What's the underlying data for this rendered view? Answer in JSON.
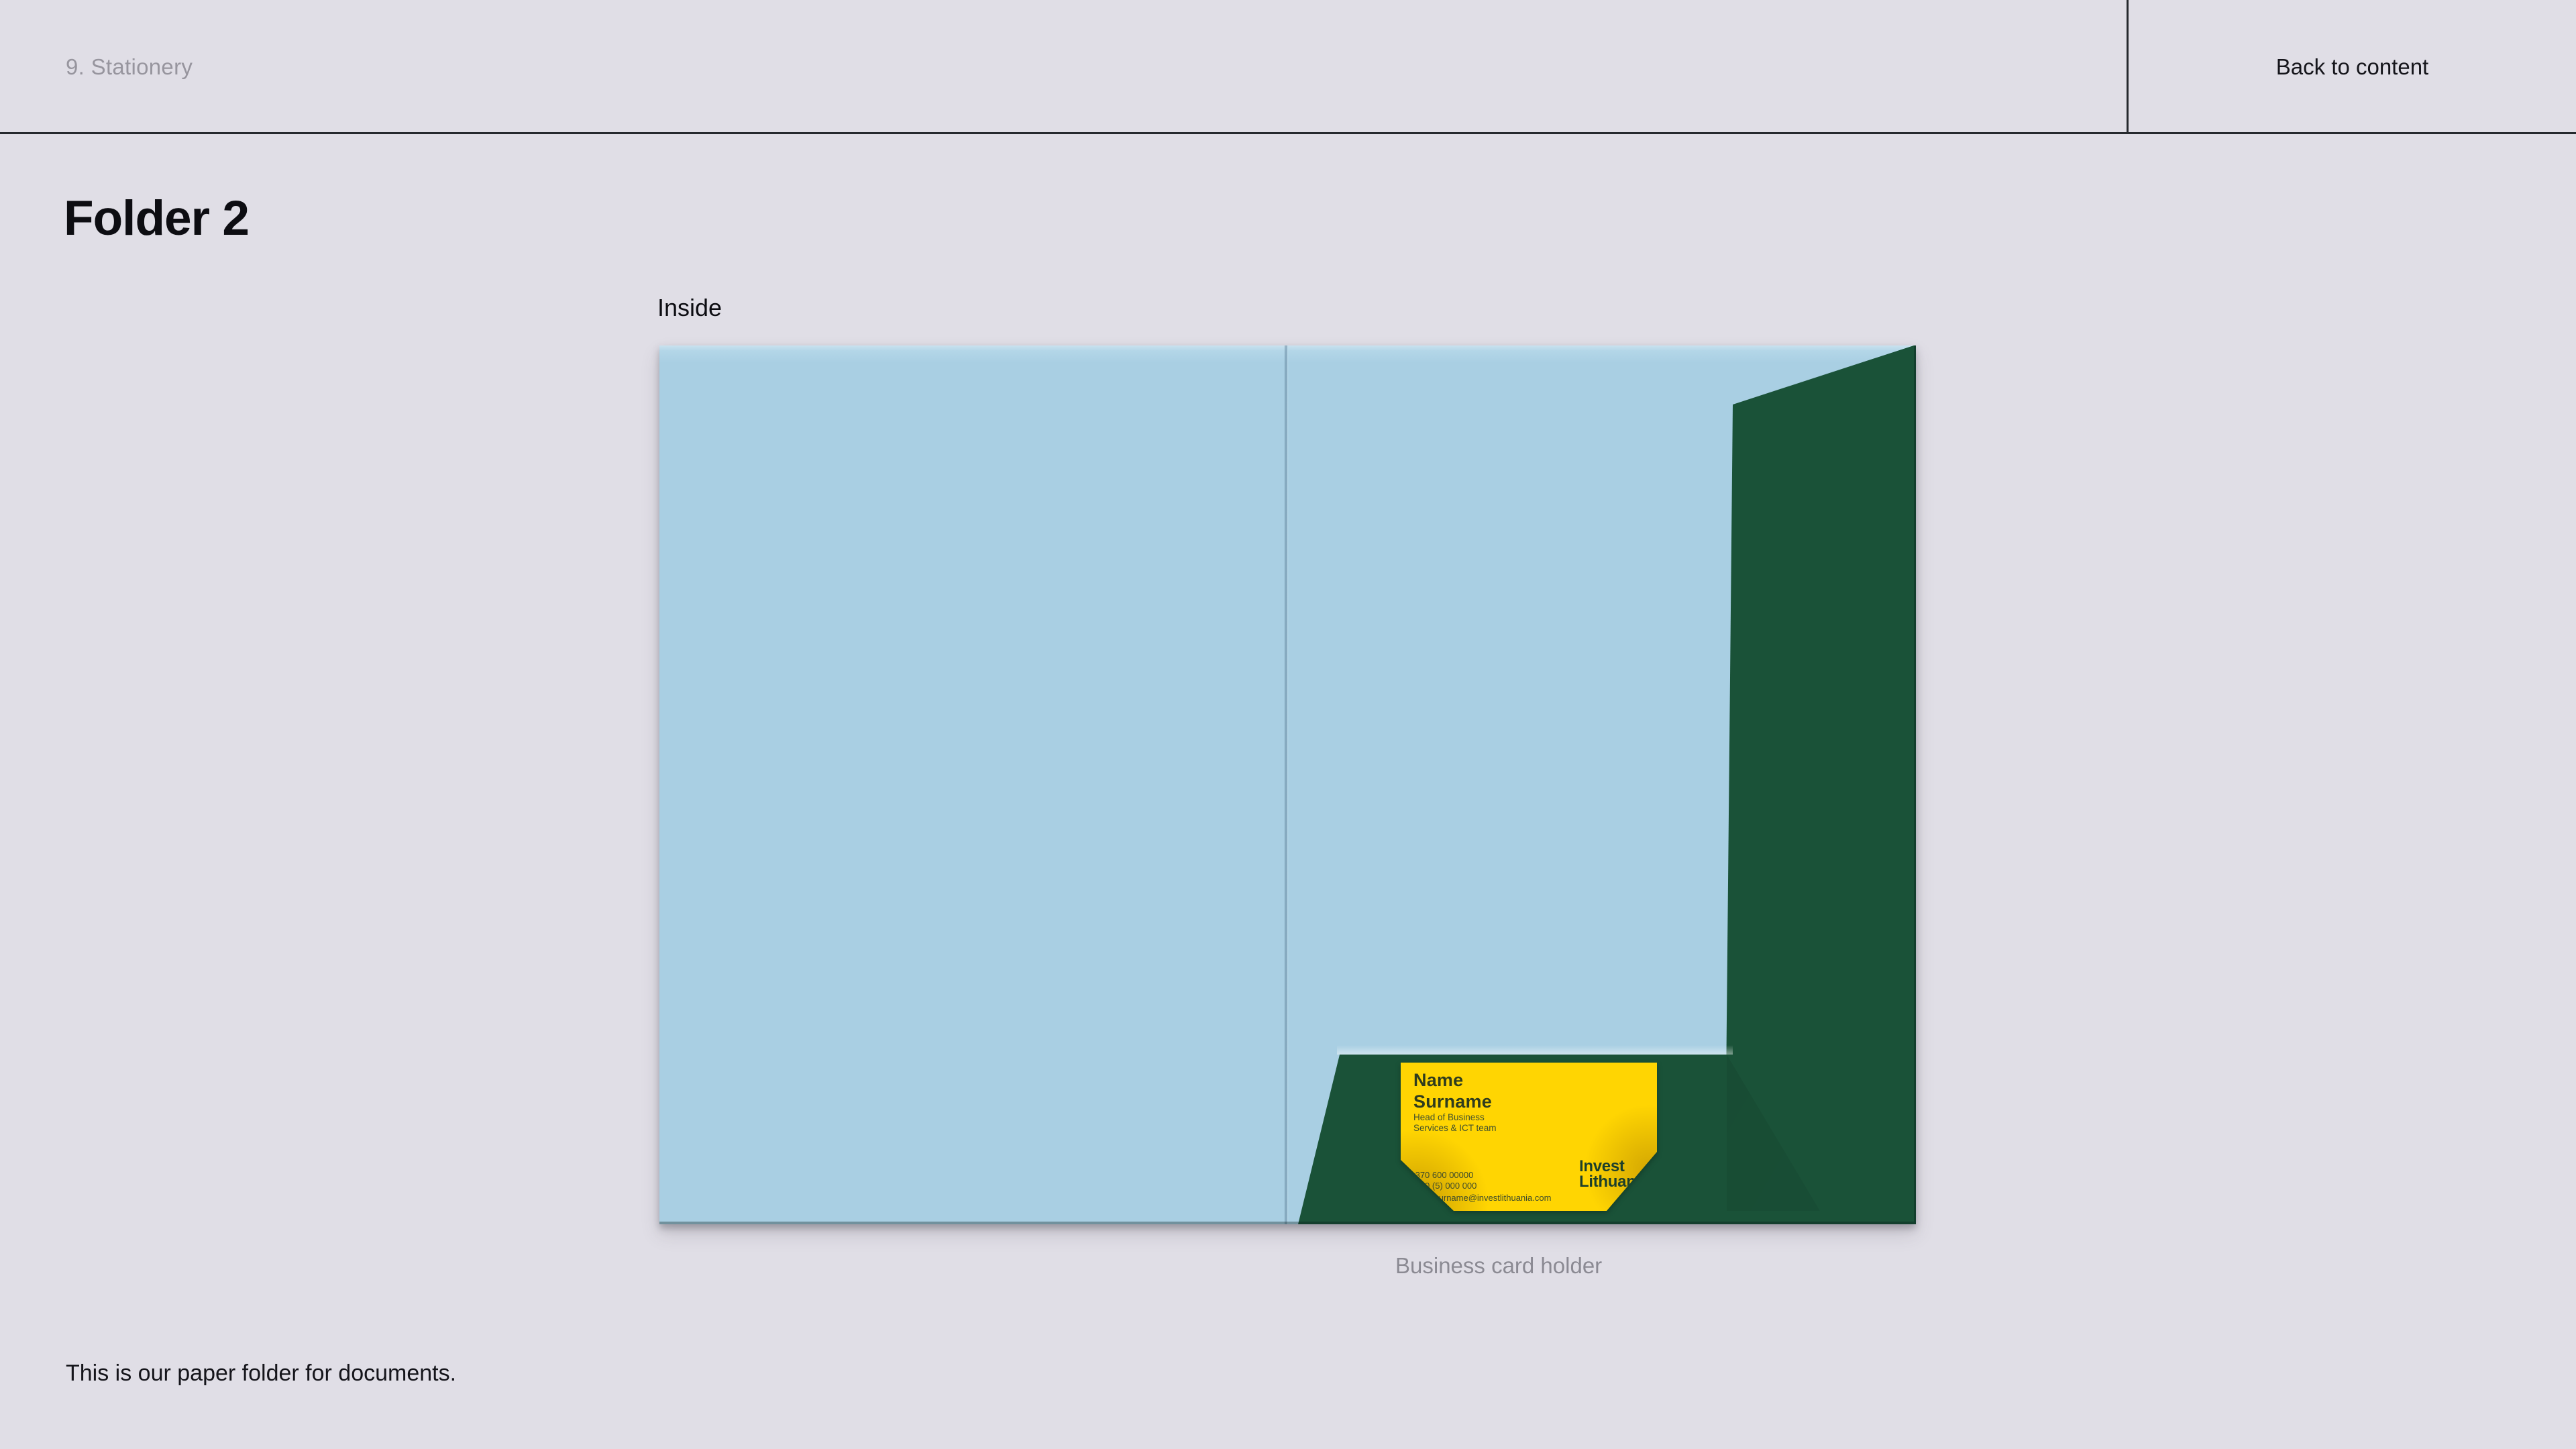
{
  "header": {
    "section_label": "9. Stationery",
    "back_link_label": "Back to content"
  },
  "page": {
    "title": "Folder 2",
    "figure_label": "Inside",
    "figure_caption": "Business card holder",
    "description": "This is our paper folder for documents."
  },
  "business_card": {
    "name_line1": "Name",
    "name_line2": "Surname",
    "role_line1": "Head of Business",
    "role_line2": "Services & ICT team",
    "phone1": "+370 600 00000",
    "phone2": "+370 (5) 000 000",
    "email": "name.surname@investlithuania.com",
    "logo_line1": "Invest",
    "logo_line2": "Lithuania"
  },
  "colors": {
    "page_background": "#e0dee6",
    "rule_line": "#26292e",
    "muted_text": "#97959e",
    "dark_text": "#15151b",
    "folder_blue": "#a9cfe3",
    "folder_green": "#1a5238",
    "card_yellow": "#ffd502",
    "card_text_green": "#2f3c1e",
    "logo_green": "#1c3f2b"
  }
}
